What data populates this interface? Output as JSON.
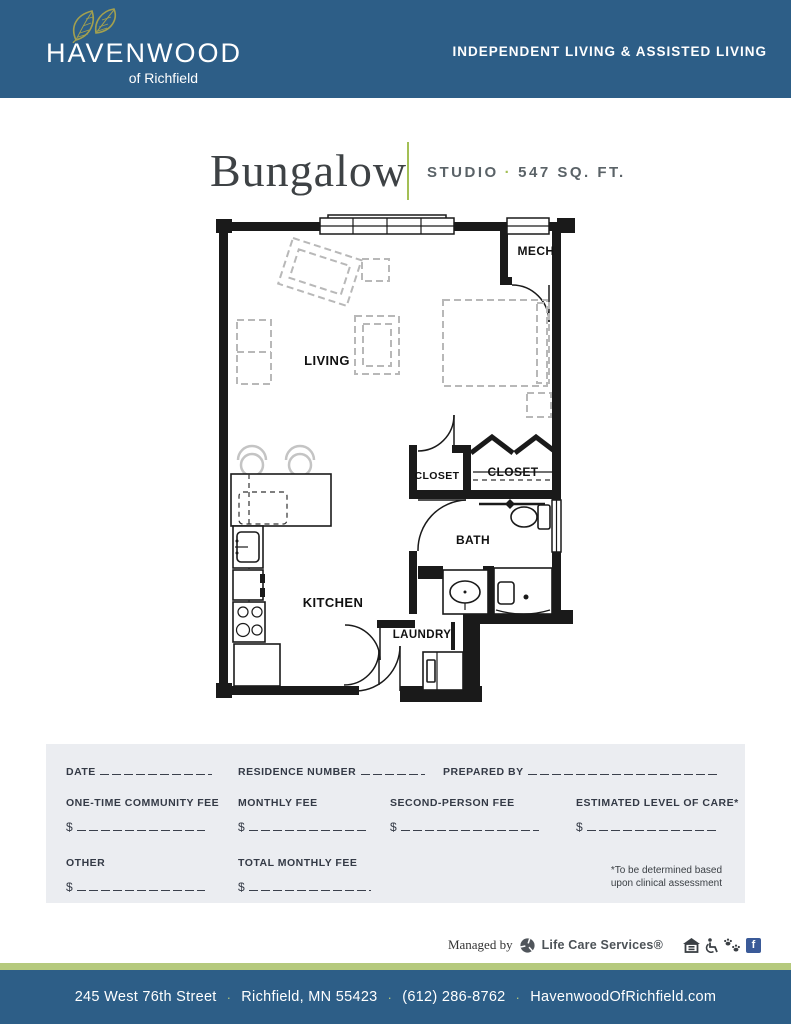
{
  "header": {
    "logo": {
      "name": "HAVENWOOD",
      "tagline": "of Richfield"
    },
    "banner": "INDEPENDENT LIVING & ASSISTED LIVING"
  },
  "title": {
    "name": "Bungalow",
    "unit_type": "STUDIO",
    "separator": "·",
    "area": "547 SQ. FT."
  },
  "floorplan": {
    "rooms": {
      "mech": "MECH",
      "living": "LIVING",
      "closet_left": "CLOSET",
      "closet_right": "CLOSET",
      "bath": "BATH",
      "kitchen": "KITCHEN",
      "laundry": "LAUNDRY"
    }
  },
  "form": {
    "date_label": "DATE",
    "residence_label": "RESIDENCE NUMBER",
    "prepared_label": "PREPARED BY",
    "fees": [
      {
        "label": "ONE-TIME COMMUNITY FEE",
        "currency": "$"
      },
      {
        "label": "MONTHLY FEE",
        "currency": "$"
      },
      {
        "label": "SECOND-PERSON FEE",
        "currency": "$"
      },
      {
        "label": "ESTIMATED LEVEL OF CARE*",
        "currency": "$"
      },
      {
        "label": "OTHER",
        "currency": "$"
      },
      {
        "label": "TOTAL MONTHLY FEE",
        "currency": "$"
      }
    ],
    "footnote_line1": "*To be determined based",
    "footnote_line2": "upon clinical assessment"
  },
  "managed_by": {
    "prefix": "Managed by",
    "company": "Life Care Services®",
    "facebook_glyph": "f"
  },
  "footer": {
    "address": "245 West 76th Street",
    "city_state": "Richfield, MN 55423",
    "phone": "(612) 286-8762",
    "website": "HavenwoodOfRichfield.com",
    "separator": "·"
  },
  "colors": {
    "brand_blue": "#2d5e87",
    "accent_green": "#a3bf55",
    "stripe_green": "#b5c97d",
    "leaf_olive": "#a3a04f",
    "facebook_blue": "#3a5a98",
    "form_bg": "#ebedf1",
    "text_dark": "#343a46"
  }
}
